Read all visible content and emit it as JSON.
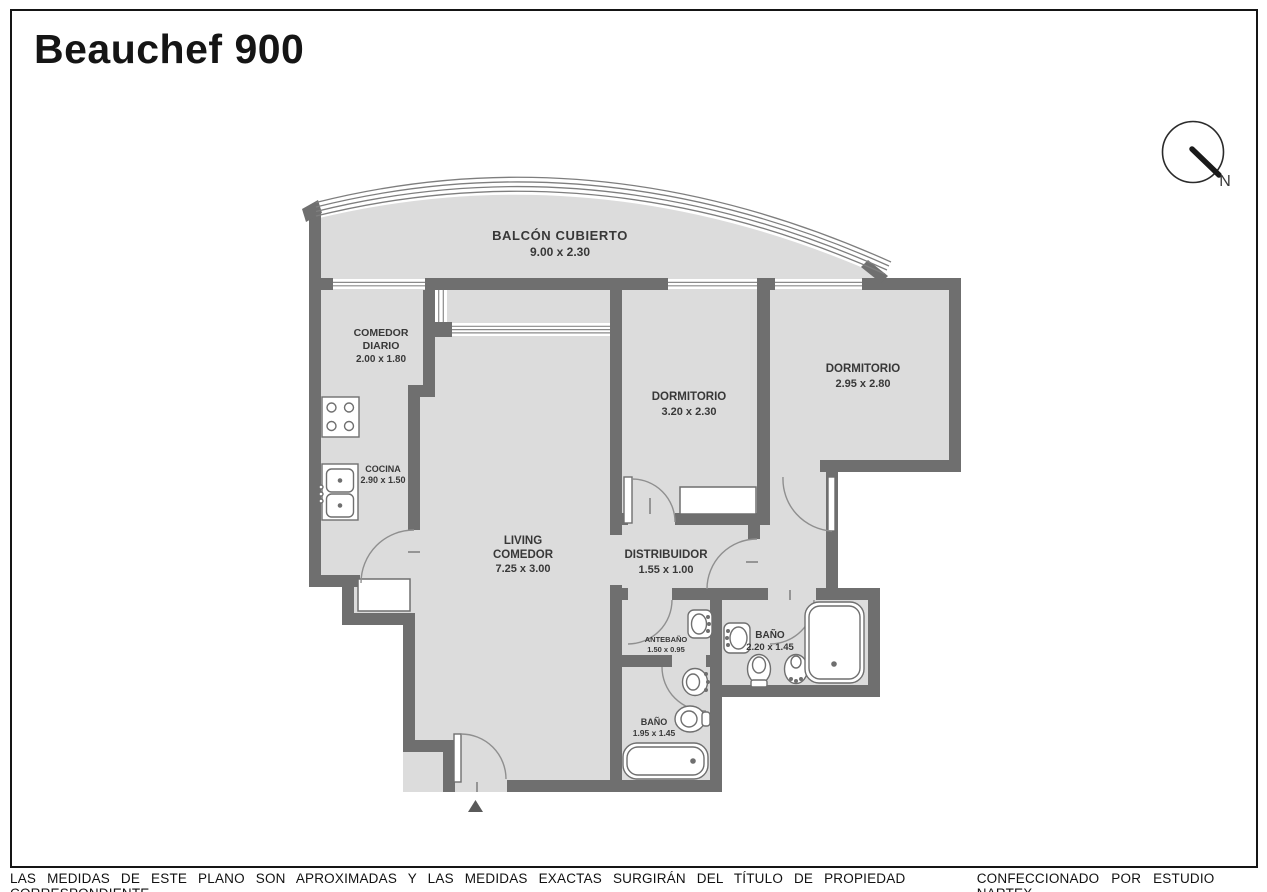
{
  "header": {
    "title": "Beauchef 900"
  },
  "compass": {
    "label": "N"
  },
  "rooms": {
    "balcon": {
      "name": "BALCÓN CUBIERTO",
      "dims": "9.00 x 2.30"
    },
    "comedor_diario": {
      "line1": "COMEDOR",
      "line2": "DIARIO",
      "dims": "2.00 x 1.80"
    },
    "cocina": {
      "name": "COCINA",
      "dims": "2.90 x 1.50"
    },
    "living": {
      "line1": "LIVING",
      "line2": "COMEDOR",
      "dims": "7.25 x 3.00"
    },
    "dormitorio1": {
      "name": "DORMITORIO",
      "dims": "3.20 x 2.30"
    },
    "dormitorio2": {
      "name": "DORMITORIO",
      "dims": "2.95 x 2.80"
    },
    "distribuidor": {
      "name": "DISTRIBUIDOR",
      "dims": "1.55 x 1.00"
    },
    "antebano": {
      "name": "ANTEBAÑO",
      "dims": "1.50 x 0.95"
    },
    "bano_suite": {
      "name": "BAÑO",
      "dims": "2.20 x 1.45"
    },
    "bano_principal": {
      "name": "BAÑO",
      "dims": "1.95 x 1.45"
    }
  },
  "footer": {
    "disclaimer": "LAS MEDIDAS  DE ESTE PLANO SON APROXIMADAS Y LAS MEDIDAS EXACTAS SURGIRÁN DEL TÍTULO DE PROPIEDAD CORRESPONDIENTE.",
    "credit": "CONFECCIONADO POR ESTUDIO NARTEX"
  },
  "colors": {
    "wall": "#6f6f6f",
    "floor": "#dcdcdc",
    "line": "#151515"
  }
}
